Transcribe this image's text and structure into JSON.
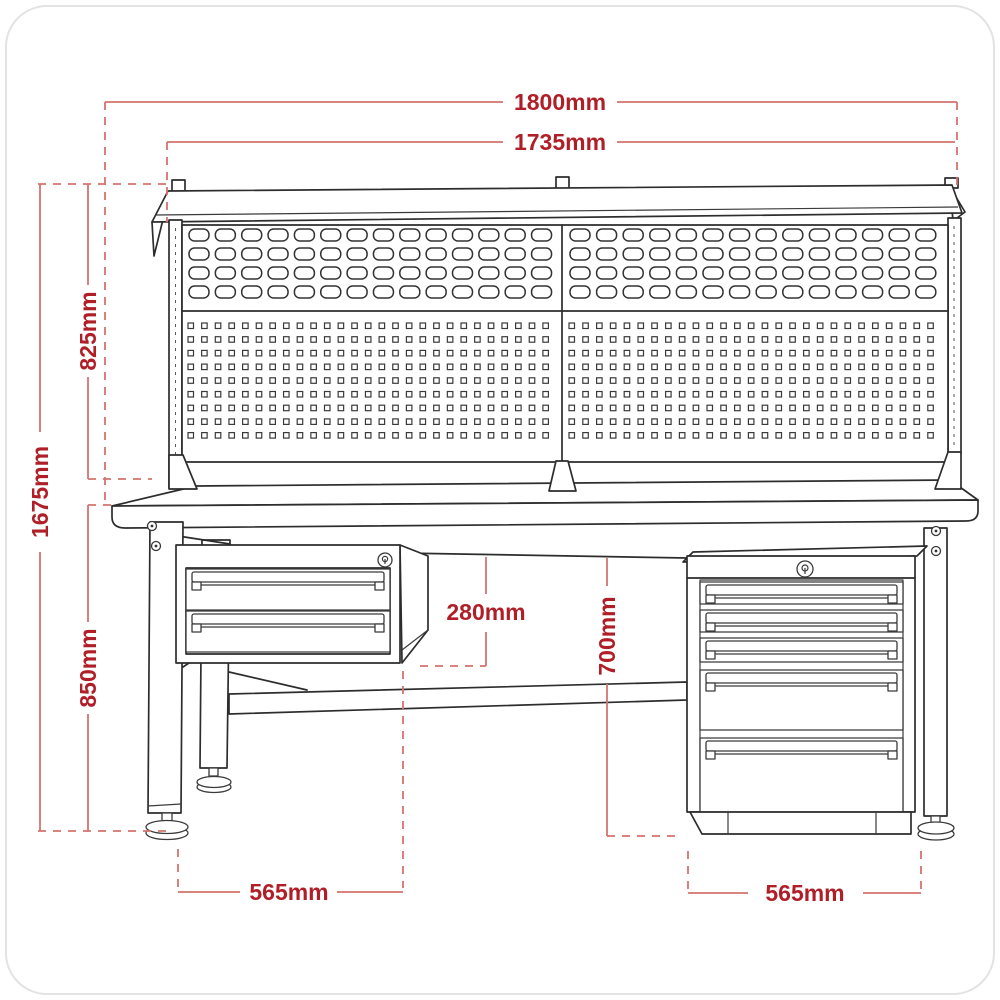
{
  "diagram": {
    "type": "workbench-dimension-drawing",
    "dimension_unit": "mm",
    "dimensions": {
      "overall_width": "1800mm",
      "back_panel_width": "1735mm",
      "overall_height": "1675mm",
      "back_panel_height": "825mm",
      "worktop_height": "850mm",
      "suspended_unit_height": "280mm",
      "underbench_clearance": "700mm",
      "left_footprint_depth": "565mm",
      "cabinet_width": "565mm"
    },
    "colors": {
      "dimension_text": "#b01f28",
      "dimension_line": "#d5736e",
      "outline": "#2d2d2d",
      "background": "#ffffff",
      "card_border": "#e3e3e3"
    },
    "back_panels": {
      "count": 2,
      "louvre_rows": 4,
      "louvre_cols_per_panel": 14,
      "pegboard_rows": 9,
      "pegboard_cols_per_panel": 27
    },
    "cabinet": {
      "drawer_count": 5,
      "lock_count": 1
    },
    "suspended_unit": {
      "drawer_count": 2,
      "lock_count": 1
    },
    "visible_leveling_feet": 3
  }
}
